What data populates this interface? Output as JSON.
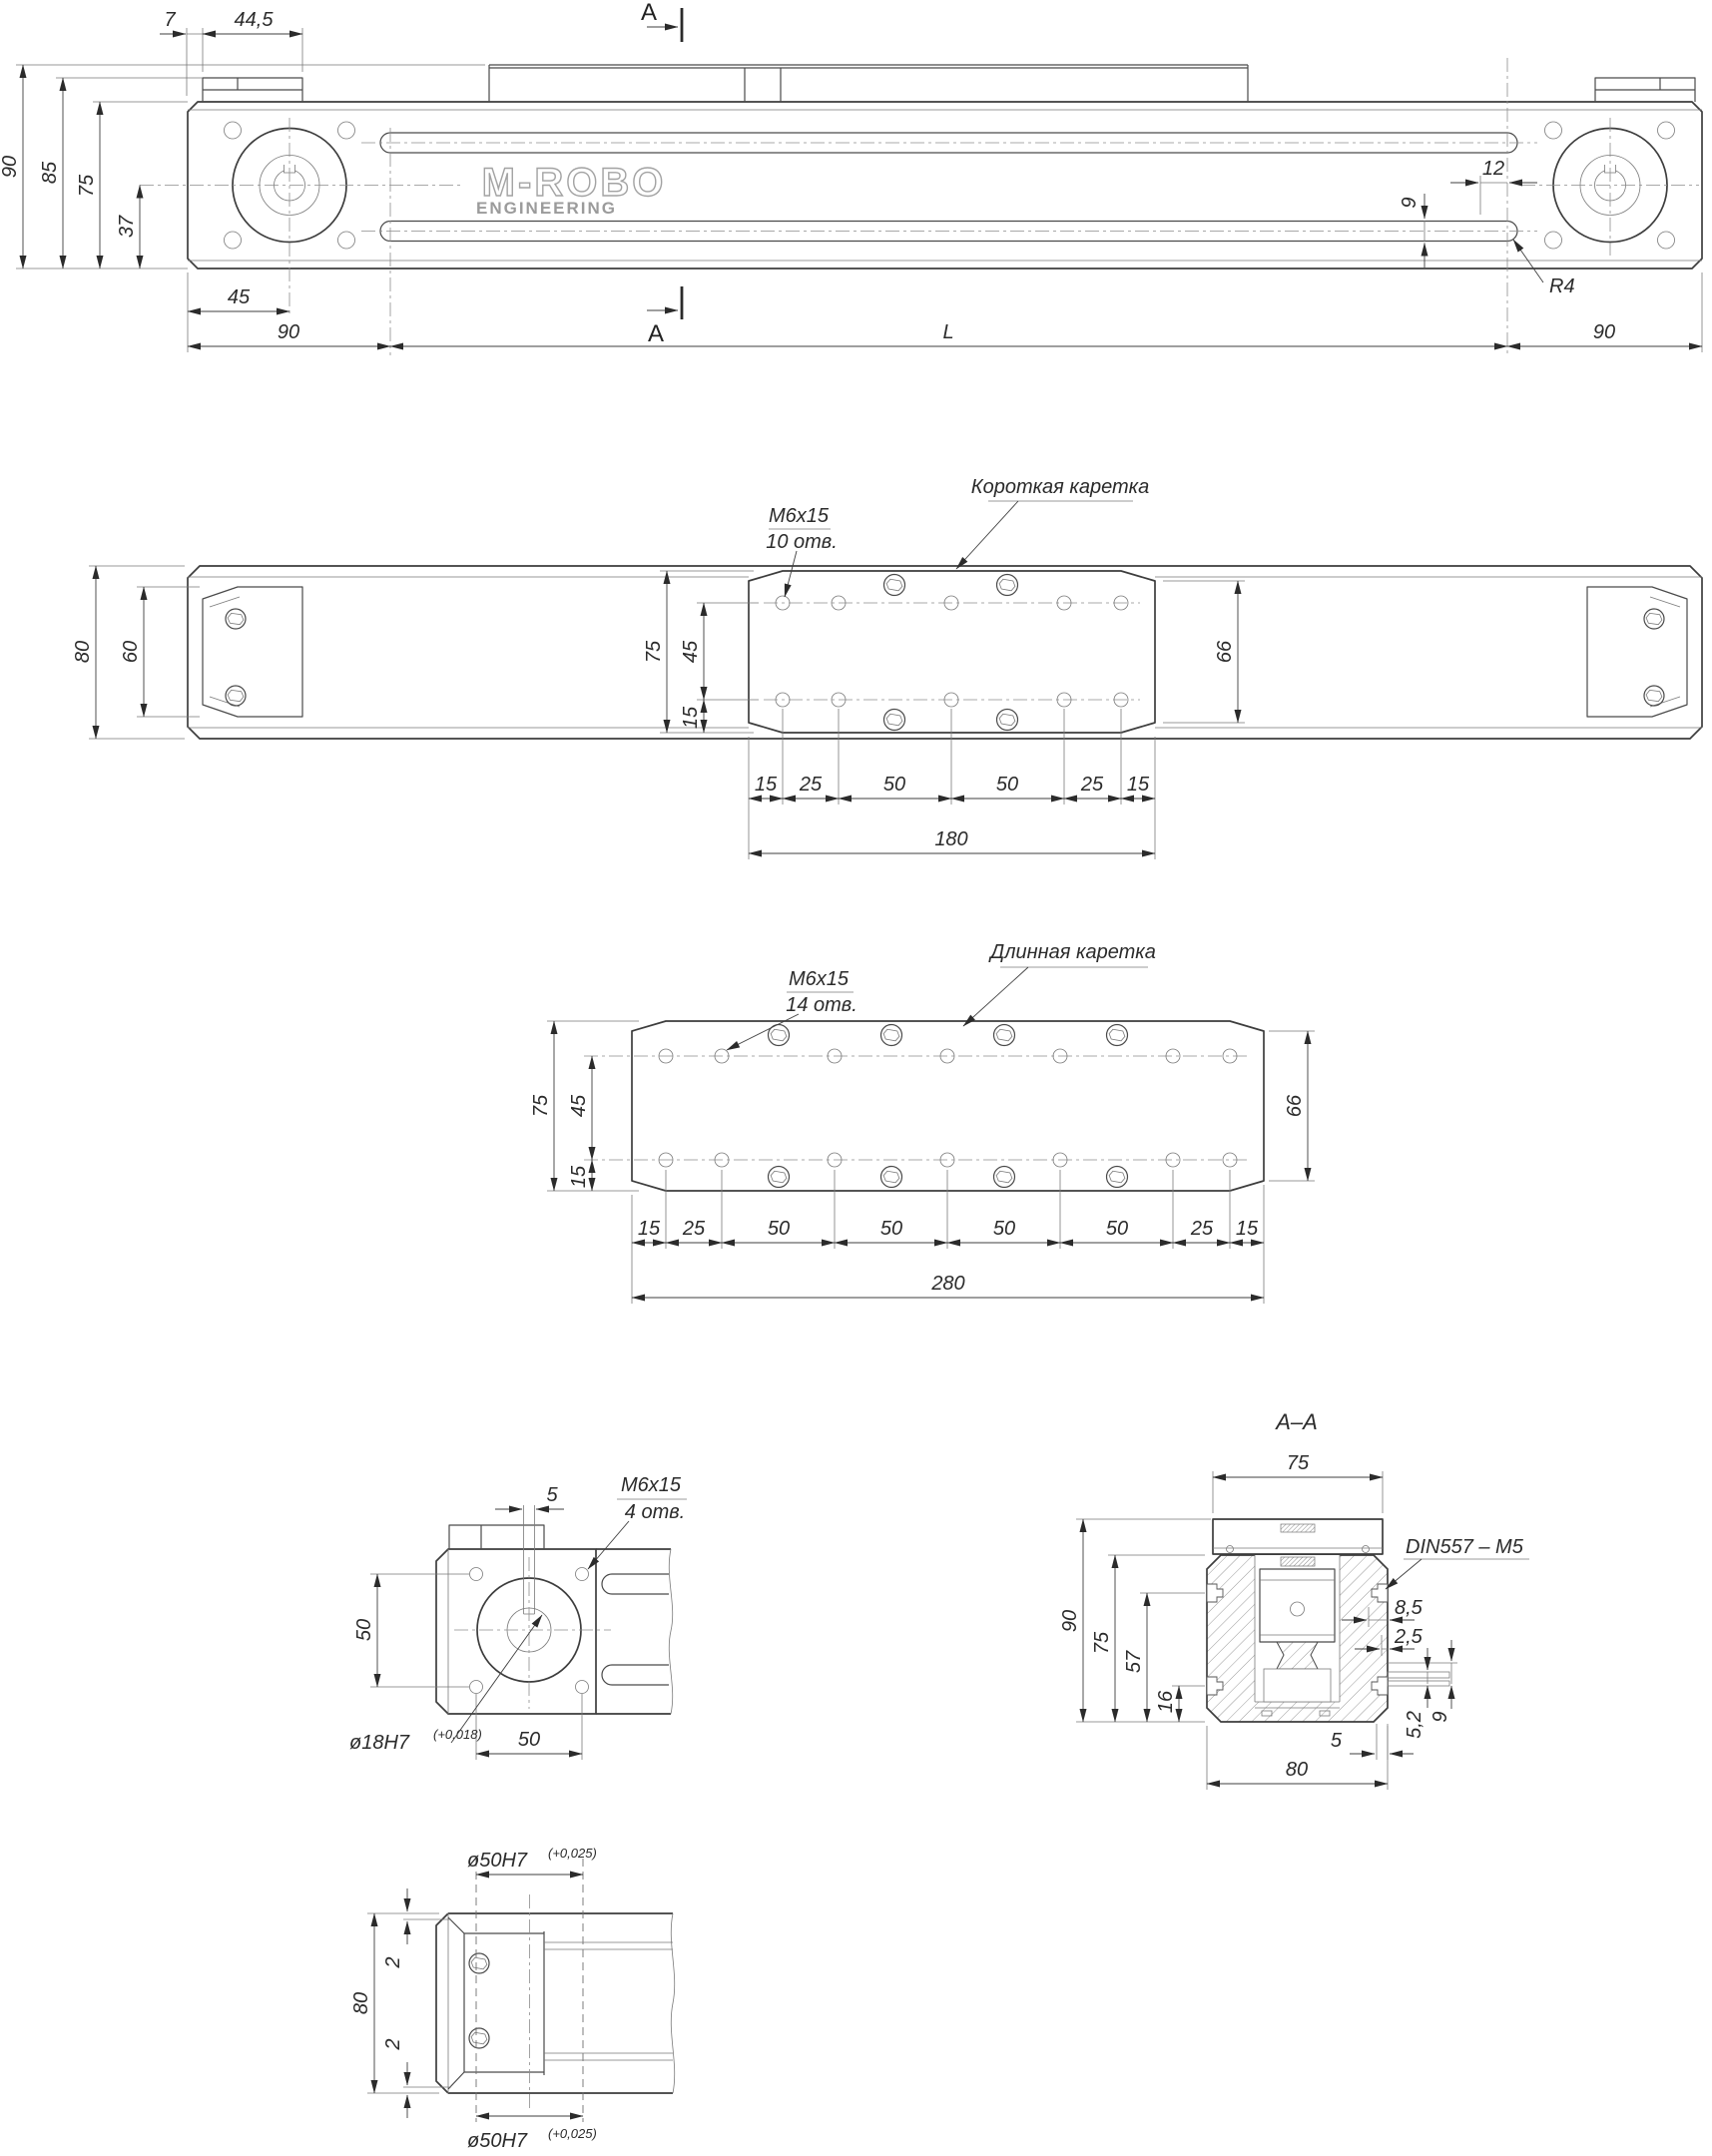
{
  "logo": {
    "brand": "M-ROBO",
    "sub": "ENGINEERING"
  },
  "side": {
    "sec_top": "A",
    "sec_bottom": "A",
    "d7": "7",
    "d44": "44,5",
    "d90l": "90",
    "d85": "85",
    "d75": "75",
    "d37": "37",
    "d45": "45",
    "db90l": "90",
    "dbl": "L",
    "db90r": "90",
    "d12": "12",
    "d9": "9",
    "r4": "R4"
  },
  "plan": {
    "m6": "M6x15",
    "holes": "10 отв.",
    "name": "Короткая каретка",
    "d80": "80",
    "d60": "60",
    "d75": "75",
    "d45": "45",
    "d15": "15",
    "d66": "66",
    "r": [
      "15",
      "25",
      "50",
      "50",
      "25",
      "15"
    ],
    "total": "180"
  },
  "lng": {
    "m6": "M6x15",
    "holes": "14 отв.",
    "name": "Длинная каретка",
    "d75": "75",
    "d45": "45",
    "d15": "15",
    "d66": "66",
    "r": [
      "15",
      "25",
      "50",
      "50",
      "50",
      "50",
      "25",
      "15"
    ],
    "total": "280"
  },
  "motor": {
    "d5": "5",
    "m6": "M6x15",
    "holes": "4 отв.",
    "d50v": "50",
    "d50h": "50",
    "bore": "ø18H7",
    "tol": "(+0,018)"
  },
  "sec": {
    "title": "A–A",
    "d75t": "75",
    "din": "DIN557 – M5",
    "d90": "90",
    "d75": "75",
    "d57": "57",
    "d16": "16",
    "d85": "8,5",
    "d25": "2,5",
    "d52": "5,2",
    "d9": "9",
    "d5": "5",
    "d80": "80"
  },
  "bore": {
    "top": "ø50H7",
    "toltop": "(+0,025)",
    "bot": "ø50H7",
    "tolbot": "(+0,025)",
    "d80": "80",
    "d2t": "2",
    "d2b": "2"
  }
}
